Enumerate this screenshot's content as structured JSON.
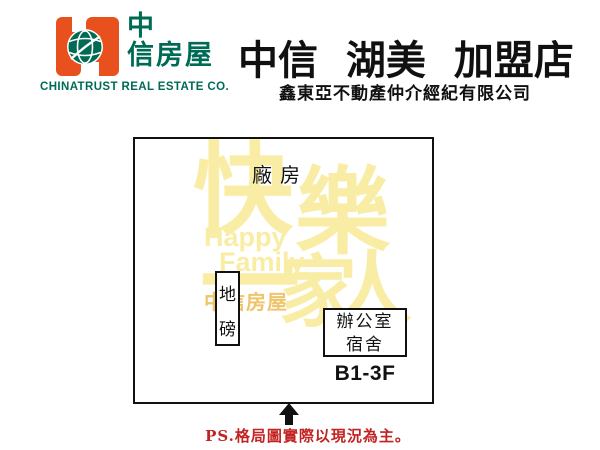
{
  "brand": {
    "logo_text_line1": "中",
    "logo_text_line2": "信房屋",
    "company_en": "CHINATRUST REAL ESTATE CO."
  },
  "header": {
    "title": "中信 湖美 加盟店",
    "subtitle": "鑫東亞不動產仲介經紀有限公司"
  },
  "floorplan": {
    "factory_label": "廠房",
    "weighbridge": {
      "line1": "地",
      "line2": "磅"
    },
    "office": {
      "line1": "辦公室",
      "line2": "宿舍"
    },
    "floors_label": "B1-3F",
    "watermark": {
      "cn": [
        "快",
        "樂",
        "一",
        "家",
        "人"
      ],
      "en": [
        "Happy",
        "Family"
      ],
      "brand_small": "中信房屋"
    }
  },
  "footer": {
    "note": "PS.格局圖實際以現況為主。"
  },
  "colors": {
    "logo_orange": "#E8501E",
    "logo_green": "#006B55",
    "title_black": "#101010",
    "watermark_yellow": "#F9EDA6",
    "watermark_orange": "#EFC46B",
    "note_red": "#C22222"
  }
}
